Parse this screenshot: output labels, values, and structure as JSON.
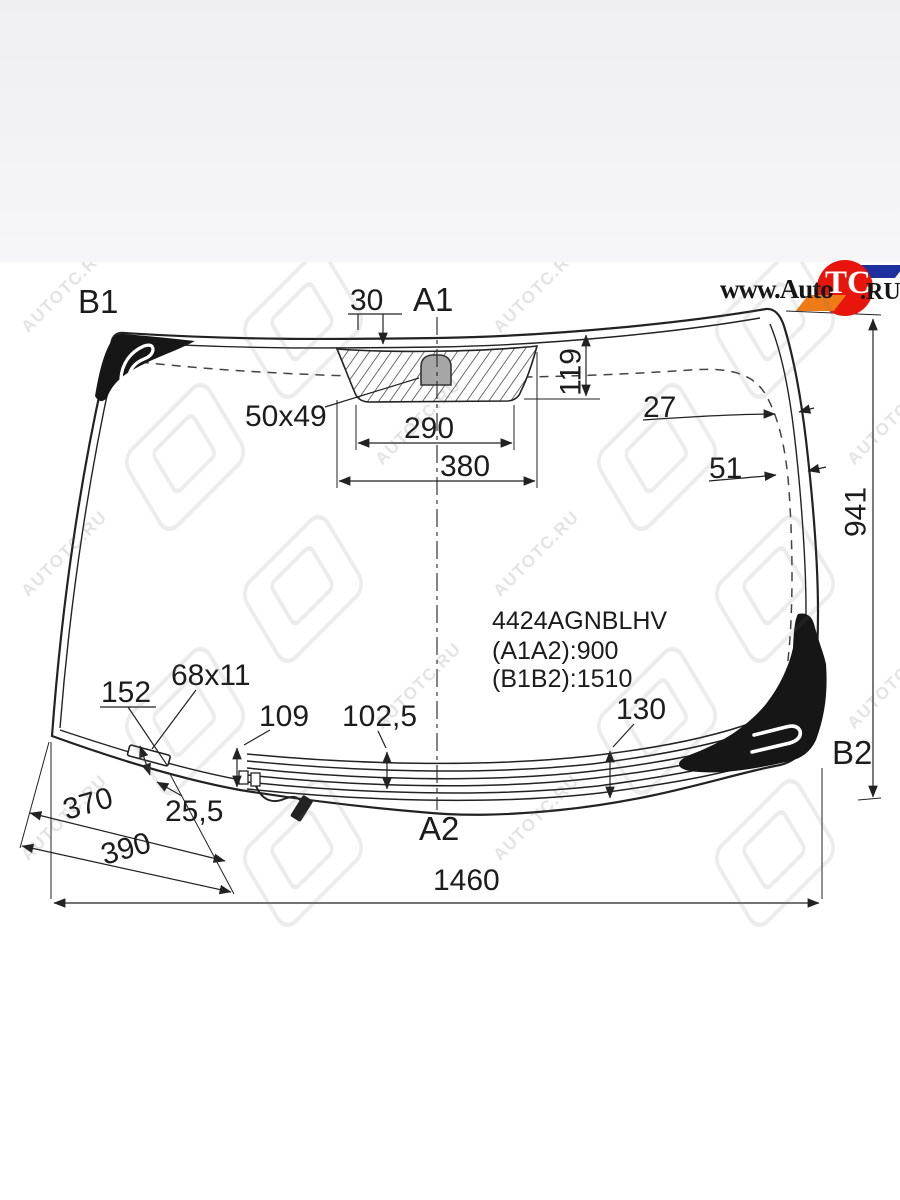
{
  "site_logo": {
    "prefix": "www.Auto",
    "circle_text": "TC",
    "suffix": ".RU",
    "circle_color": "#e8150d",
    "flag_blue_color": "#1e2f9e",
    "flag_orange_color": "#ee7b17"
  },
  "watermark": {
    "text": "AUTOTC.RU"
  },
  "part_info": {
    "code": "4424AGNBLHV",
    "dim_a": "(A1A2):900",
    "dim_b": "(B1B2):1510"
  },
  "labels": {
    "b1": "B1",
    "a1": "A1",
    "a2": "A2",
    "b2": "B2",
    "top_band_offset": "30",
    "mirror_mount_size": "50x49",
    "mount_zone_width": "290",
    "shade_band_width": "380",
    "shade_band_height": "119",
    "side_band_upper": "27",
    "side_band_lower": "51",
    "glass_height": "941",
    "left_edge_len": "152",
    "sensor_window": "68x11",
    "heater_h_left": "109",
    "heater_h_mid": "102,5",
    "heater_h_right": "130",
    "sensor_offset": "25,5",
    "corner_dim_1": "370",
    "corner_dim_2": "390",
    "glass_width": "1460"
  }
}
